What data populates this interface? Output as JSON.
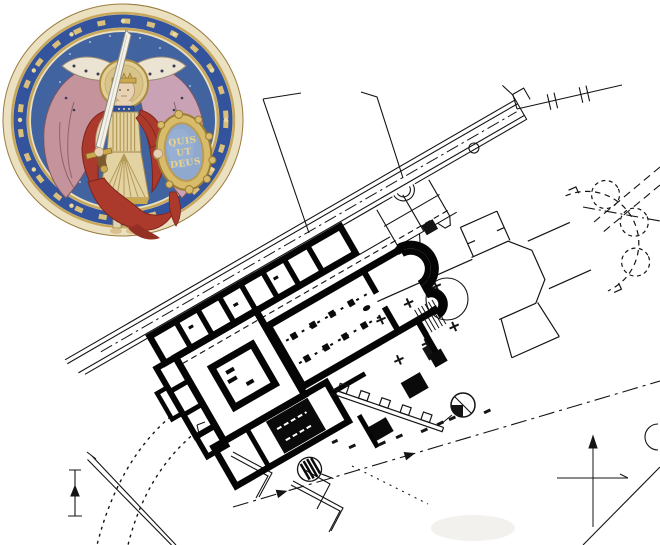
{
  "page": {
    "width": 660,
    "height": 545,
    "background": "#ffffff"
  },
  "medallion": {
    "name": "Saint Michael the Archangel roundel",
    "shield_inscription": {
      "line1": "QUIS",
      "line2": "UT",
      "line3": "DEUS"
    },
    "colors": {
      "rim_cream": "#ebe1c1",
      "gold": "#c7a75c",
      "ring_blue": "#33549c",
      "field_blue": "#41639f",
      "wing_rose": "#c4939b",
      "wing_lilac": "#c9a3b5",
      "robe_red": "#ac3a2c",
      "armor_ivory": "#e3d3a2",
      "shield_blue": "#8fa8cd",
      "flesh": "#e8d2b4"
    }
  },
  "plan": {
    "ink": "#141414",
    "heavy_ink": "#050505",
    "symbols": [
      "survey-benchmark",
      "north-cross",
      "leveling-staff",
      "tree-circle",
      "boundary-break-marks",
      "centerline-arrow"
    ]
  }
}
